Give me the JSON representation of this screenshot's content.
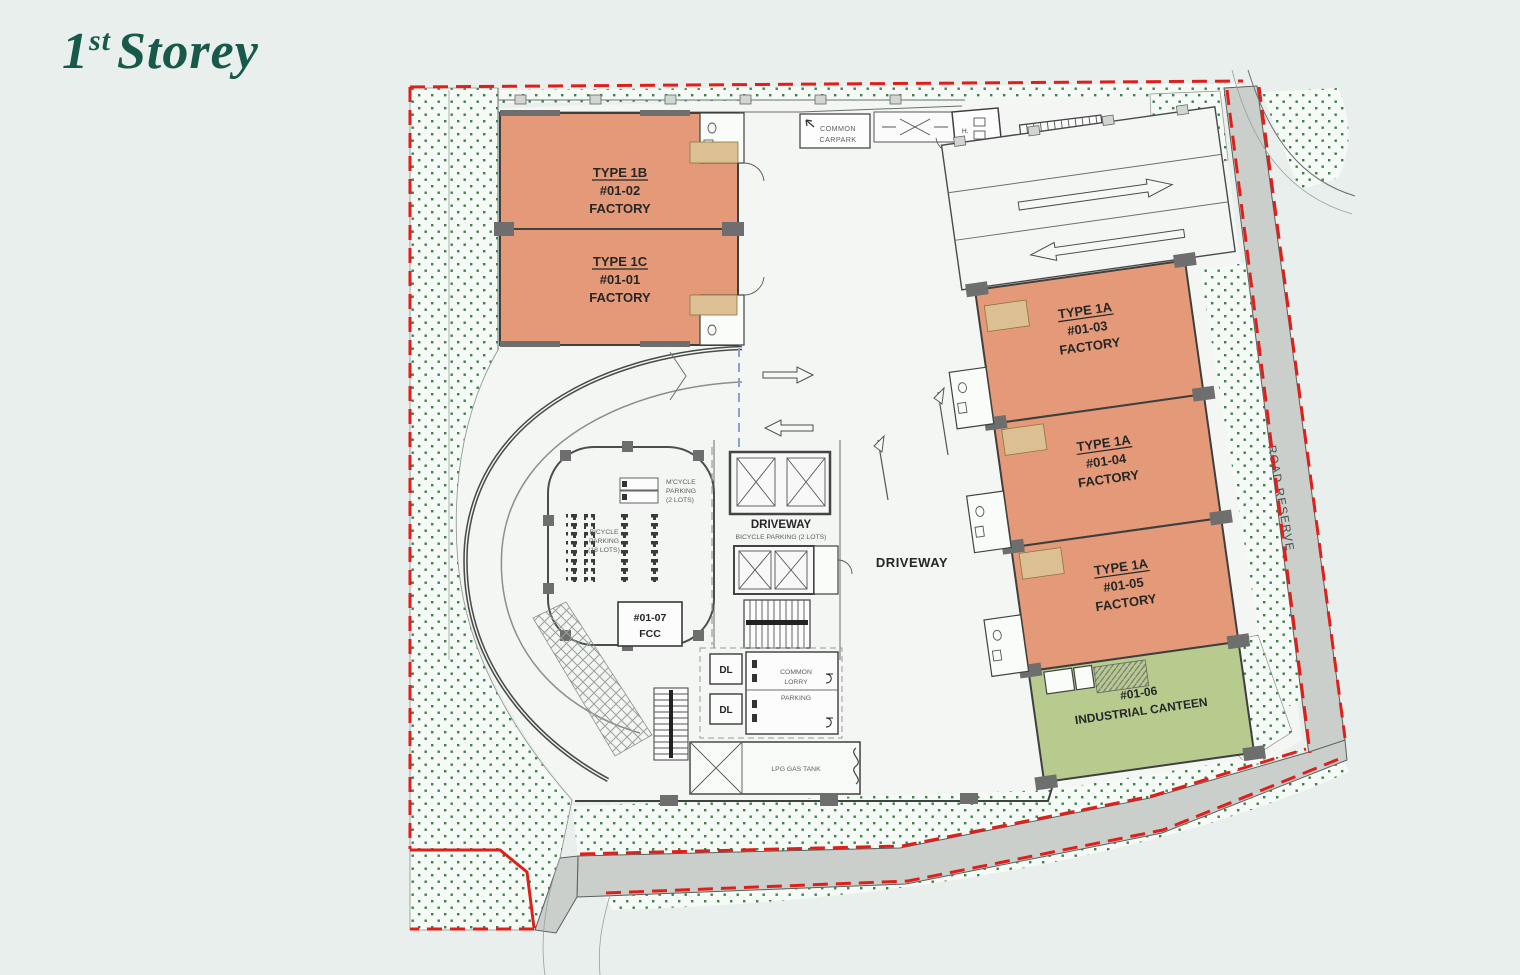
{
  "page": {
    "title_number": "1",
    "title_sup": "st",
    "title_word": "Storey",
    "title_color": "#17594a",
    "background": "#e9efec"
  },
  "plan": {
    "units": [
      {
        "type_label": "TYPE 1B",
        "unit_label": "#01-02",
        "use_label": "FACTORY"
      },
      {
        "type_label": "TYPE 1C",
        "unit_label": "#01-01",
        "use_label": "FACTORY"
      },
      {
        "type_label": "TYPE 1A",
        "unit_label": "#01-03",
        "use_label": "FACTORY"
      },
      {
        "type_label": "TYPE 1A",
        "unit_label": "#01-04",
        "use_label": "FACTORY"
      },
      {
        "type_label": "TYPE 1A",
        "unit_label": "#01-05",
        "use_label": "FACTORY"
      },
      {
        "unit_label": "#01-06",
        "use_label": "INDUSTRIAL CANTEEN"
      },
      {
        "unit_label": "#01-07",
        "use_label": "FCC"
      }
    ],
    "labels": {
      "carpark_line1": "COMMON",
      "carpark_line2": "CARPARK",
      "driveway_lift_title": "DRIVEWAY",
      "driveway_lift_sub": "BICYCLE PARKING (2 LOTS)",
      "driveway_main": "DRIVEWAY",
      "mcycle_line1": "M'CYCLE",
      "mcycle_line2": "PARKING",
      "mcycle_line3": "(2 LOTS)",
      "bicycle_line1": "BICYCLE",
      "bicycle_line2": "PARKING",
      "bicycle_line3": "(18 LOTS)",
      "lorry_line1": "COMMON",
      "lorry_line2": "LORRY",
      "lorry_line3": "PARKING",
      "dl": "DL",
      "lpg": "LPG GAS TANK",
      "road_reserve": "ROAD RESERVE",
      "h_room": "H."
    },
    "colors": {
      "factory_fill": "#e49a79",
      "canteen_fill": "#b7cb8f",
      "road_fill": "#cacfcc",
      "boundary_red": "#e01f1b",
      "landscape_dot": "#3c8049",
      "paving": "#f3f6f3"
    }
  }
}
